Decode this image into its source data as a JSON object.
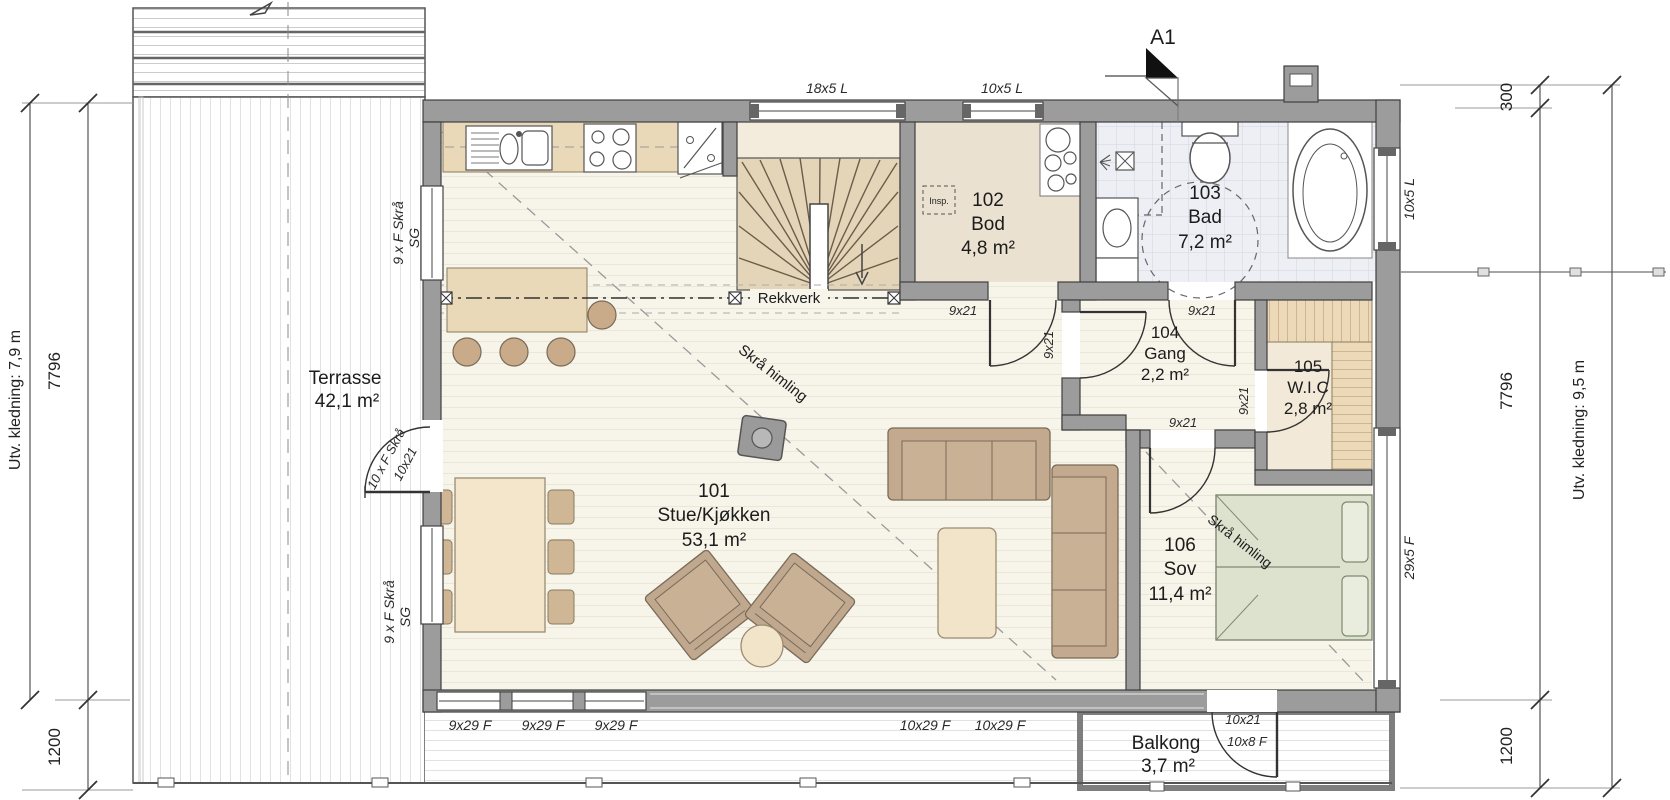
{
  "annotations": {
    "section_marker": "A1",
    "railing": "Rekkverk",
    "sloped_ceiling": "Skrå himling",
    "inspection": "Insp."
  },
  "rooms": [
    {
      "number": "101",
      "name": "Stue/Kjøkken",
      "area": "53,1 m²"
    },
    {
      "number": "102",
      "name": "Bod",
      "area": "4,8 m²"
    },
    {
      "number": "103",
      "name": "Bad",
      "area": "7,2 m²"
    },
    {
      "number": "104",
      "name": "Gang",
      "area": "2,2 m²"
    },
    {
      "number": "105",
      "name": "W.I.C",
      "area": "2,8 m²"
    },
    {
      "number": "106",
      "name": "Sov",
      "area": "11,4 m²"
    }
  ],
  "outdoor": {
    "terrace": {
      "name": "Terrasse",
      "area": "42,1 m²"
    },
    "balcony": {
      "name": "Balkong",
      "area": "3,7 m²"
    }
  },
  "windows": {
    "top1": "18x5 L",
    "top2": "10x5 L",
    "right1": "10x5 L",
    "right2": "29x5 F",
    "bottom": [
      "9x29 F",
      "9x29 F",
      "9x29 F",
      "10x29 F",
      "10x29 F"
    ],
    "left1a": "9 x F Skrå",
    "left1b": "SG",
    "left2a": "9 x F Skrå",
    "left2b": "SG"
  },
  "doors": {
    "interior": [
      "9x21",
      "9x21",
      "9x21",
      "9x21",
      "9x21"
    ],
    "terrace_a": "10 x F Skrå",
    "terrace_b": "10x21",
    "balcony_a": "10x21",
    "balcony_b": "10x8 F"
  },
  "dimensions": {
    "left": {
      "total": "7796",
      "deck": "1200",
      "cladding": "Utv. kledning: 7,9 m"
    },
    "right": {
      "overhang": "300",
      "total": "7796",
      "deck": "1200",
      "cladding": "Utv. kledning: 9,5 m"
    }
  },
  "colors": {
    "wall": "#9c9c9c",
    "floor": "#f7f4ea",
    "counter": "#ead9b9",
    "stairs": "#e5d5b8",
    "tile": "#edeff4",
    "bed": "#dde2cf",
    "sofa": "#c3aa8f"
  }
}
